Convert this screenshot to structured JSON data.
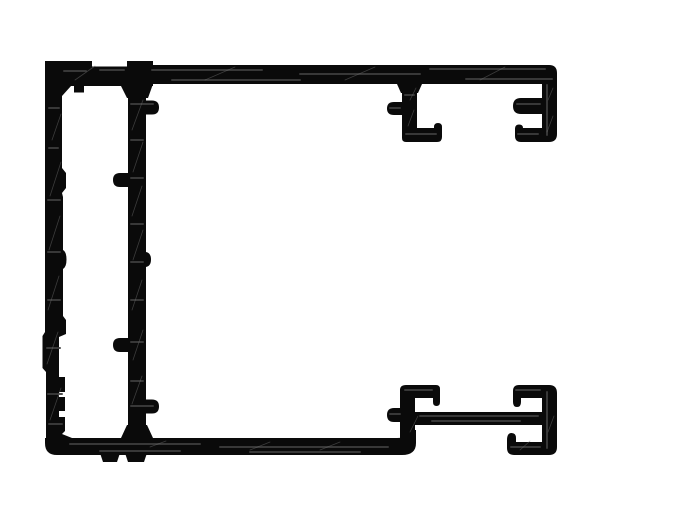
{
  "meta": {
    "title": "Aluminium extrusion profile cross-section",
    "description": "Black technical cross-section drawing of an aluminium frame extrusion on a white background. A large C-shaped frame (top bar, left wall with serrated inner teeth, bottom bar) with an inner vertical web wall carrying round-tipped screw-boss nubs, two downward hook channels hanging from the right end of the top bar, and an H-shaped double C-channel assembly at the bottom right."
  },
  "palette": {
    "ink": "#0a0a0a",
    "paper": "#ffffff",
    "streak": "#3d3d3d",
    "hatch": "#6e6e6e"
  },
  "profile": {
    "fills": {
      "left_wall": "M45,75 Q45,61 59,61 L62,61 L62,168 L66,173 L66,188 L62,193 L63,197 L63,250 Q66.5,252 66.5,259.5 Q66.5,267 63,269 L63,316 L66,320 L66,334 L59,337 L59,377 L65,377 L65,392 L59,392 L59,397 L65,397 L65,411 L59,411 L59,417 L65,417 L65,431 L61,435 L61,441 L46,441 L46,372 L42.5,368 L42.5,336 L45,332 Z",
      "top_bar_left": "M45,61 L153,61 L153,86 L45,86 Z",
      "top_bar_main": "M150,65 L545,65 L545,84 L150,84 Z",
      "wall_fillet_top": "M62,86 L71,86 L62,96 Z",
      "wall_fillet_bottom": "M59,427 L62,434 L72,438 L59,438 Z",
      "hang_tab": "M74,86 L84,86 L84,92.5 L74,92.5 Z",
      "inner_wall": "M128,84 L146,84 L146,438 L128,438 Z",
      "inner_wall_flare_top": "M120,84 L153,84 L148,98 L127,98 Z",
      "inner_wall_flare_bottom": "M127,425 L147,425 L153,438 L121,438 Z",
      "nub_right_top": "M146,100.5 L152,100.5 Q159,100.5 159,107.5 Q159,114.5 152,114.5 L146,114.5 Z",
      "nub_left_upper": "M128,173 L128,187 L120,187 Q113,187 113,180 Q113,173 120,173 Z",
      "bump_right_mid": "M146,252 Q151,253 151,259.5 Q151,266 146,267 Z",
      "nub_left_lower": "M128,338 L128,352 L120,352 Q113,352 113,345 Q113,338 120,338 Z",
      "nub_right_bottom": "M146,399.5 L152,399.5 Q159,399.5 159,406.5 Q159,413.5 152,413.5 L146,413.5 Z",
      "bottom_bar": "M45,438 L395,438 L395,455 L57,455 Q45,455 45,443 Z",
      "foot_a": "M100,453 L120,453 L117,462 L103,462 Z",
      "foot_b": "M125,453 L147,453 L144,462 L128,462 Z",
      "bar_end_curl": "M388,438 L397,438 Q409,438 412,430 L416,430 L416,443 Q416,455 402,455 L388,455 Z",
      "tr_tee_hook": "M402,84 L417,84 L417,128 L434,128 L434,127 Q434,123 438,123 Q442,123 442,127 L442,137 Q442,142 437,142 L406,142 Q402,142 402,138 Z",
      "tr_tee_fillet": "M397,84 L422,84 L418,93 L401,93 Z",
      "tr_nub": "M402,102 L394,102 Q387,102 387,108.5 Q387,115 394,115 L402,115 Z",
      "tr_c_channel": "M542,65 L549,65 Q557,65 557,73 L557,134 Q557,142 549,142 L521,142 Q515,142 515,136 L515,129 Q515,124.5 519,124.5 Q523,124.5 523,128 L542,128 L542,114 L521,114 Q513,114 513,106 Q513,98 521,98 L542,98 Z",
      "br_tee_hook": "M400,390 Q400,385 406,385 L436,385 Q440,385 440,389 L440,402 Q440,406 436.5,406 Q433,406 433,402 L433,398 L415,398 L415,440 L400,440 Z",
      "br_nub": "M404,408 L394,408 Q387,408 387,415 Q387,422 394,422 L404,422 Z",
      "br_mid_bar": "M404,412 L542,412 L542,425 L404,425 Z",
      "br_c_channel": "M542,385 L549,385 Q557,385 557,393 L557,447 Q557,455 549,455 L514,455 Q507,455 507,448 L507,440 Q507,433 511.5,433 Q516,433 516,438 L516,442 L542,442 L542,398 L521,398 L521,402 Q521,407 517,407 Q513,407 513,402 L513,391 Q513,385 519,385 Z"
    },
    "cutouts": {
      "top_groove": "M92,58 L127,58 L127,66.5 L92,66.5 Z"
    },
    "textures": {
      "streaks": "M64,71 H86 M100,70 H124 M152,70 H262 M300,74 H420 M430,69 H545 M466,79 H552 M172,80 H300 M49,108 H59 M49,148 H58 M48,200 H60 M48,252 H60 M48,300 H60 M47,348 H60 M48,394 H62 M49,424 H62 M131,104 H153 M131,140 H143 M131,178 H143 M131,224 H143 M131,262 H143 M131,300 H143 M131,342 H143 M131,381 H143 M131,406 H153 M70,444 H200 M220,447 H388 M100,451 H180 M250,452 H360 M405,95 H414 M406,134 H436 M390,108 H400 M517,104 H540 M518,134 H538 M547,85 V135 M405,390 H432 M390,414 H400 M420,416 H538 M432,421 H520 M516,390 H540 M547,392 V448 M511,447 H540",
      "hatch": "M52,140 L61,114 M50,196 L61,162 M49,250 L60,216 M48,310 L59,276 M47,364 L58,332 M50,420 L61,388 M132,130 L143,100 M133,172 L143,142 M132,216 L142,186 M133,260 L143,230 M132,310 L142,280 M133,360 L143,330 M132,404 L142,376 M410,100 L416,88 M408,126 L414,110 M548,100 L553,88 M547,132 L553,116 M150,447 L166,441 M250,450 L270,442 M320,450 L340,442 M410,432 L418,416 M520,450 L530,441 M548,432 L554,416 M75,80 L95,66 M205,80 L235,67 M345,80 L375,67 M480,80 L505,67"
    }
  }
}
